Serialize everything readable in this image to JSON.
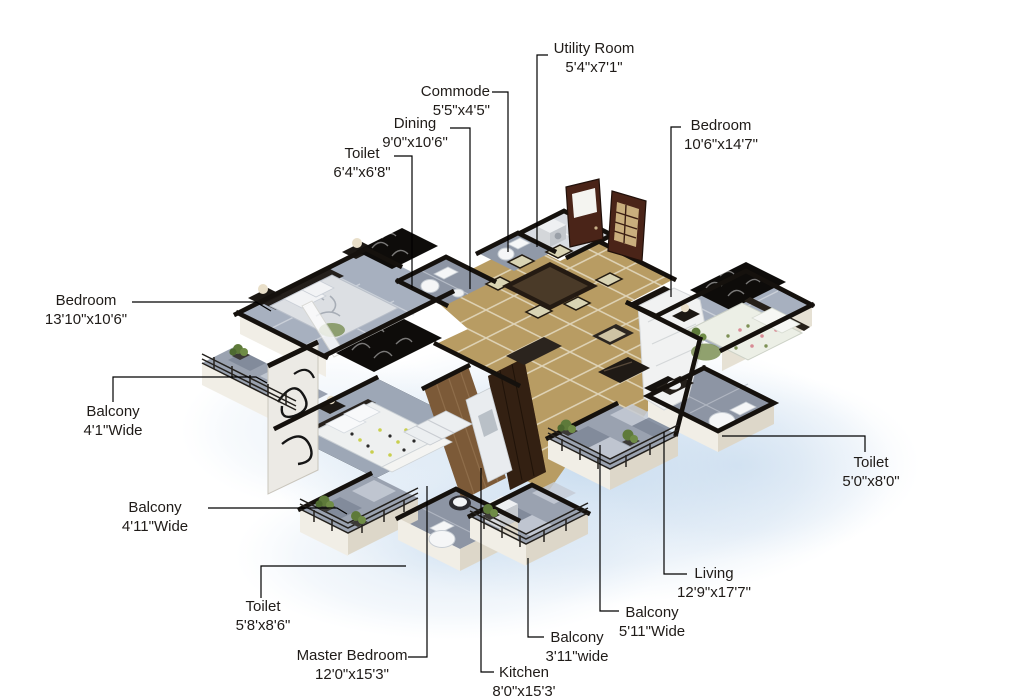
{
  "figure": {
    "type": "isometric-3d-floor-plan",
    "background_color": "#ffffff",
    "palette": {
      "wall_cap": "#15110d",
      "exterior_wall": "#f1eee6",
      "marble_floor_tan": "#b89c63",
      "bedroom_floor_gray": "#a7b0bf",
      "toilet_floor_gray": "#8d95a4",
      "balcony_floor_gray": "#9aa2b0",
      "wood_floor": "#7c5a38",
      "door_wood": "#4a2418",
      "plant_green": "#5e7a3a",
      "shadow_blue": "#b9d2ea",
      "label_text": "#1f1b18"
    }
  },
  "labels": {
    "utility": {
      "room": "Utility Room",
      "size": "5'4\"x7'1\""
    },
    "commode": {
      "room": "Commode",
      "size": "5'5\"x4'5\""
    },
    "dining": {
      "room": "Dining",
      "size": "9'0\"x10'6\""
    },
    "toilet_top": {
      "room": "Toilet",
      "size": "6'4\"x6'8\""
    },
    "bedroom_right": {
      "room": "Bedroom",
      "size": "10'6\"x14'7\""
    },
    "bedroom_left": {
      "room": "Bedroom",
      "size": "13'10\"x10'6\""
    },
    "balcony_left": {
      "room": "Balcony",
      "size": "4'1\"Wide"
    },
    "balcony_master": {
      "room": "Balcony",
      "size": "4'11\"Wide"
    },
    "toilet_master": {
      "room": "Toilet",
      "size": "5'8'x8'6\""
    },
    "master_bedroom": {
      "room": "Master Bedroom",
      "size": "12'0\"x15'3\""
    },
    "kitchen": {
      "room": "Kitchen",
      "size": "8'0\"x15'3'"
    },
    "balcony_kitchen": {
      "room": "Balcony",
      "size": "3'11\"wide"
    },
    "balcony_living": {
      "room": "Balcony",
      "size": "5'11\"Wide"
    },
    "living": {
      "room": "Living",
      "size": "12'9\"x17'7\""
    },
    "toilet_right": {
      "room": "Toilet",
      "size": "5'0\"x8'0\""
    }
  }
}
